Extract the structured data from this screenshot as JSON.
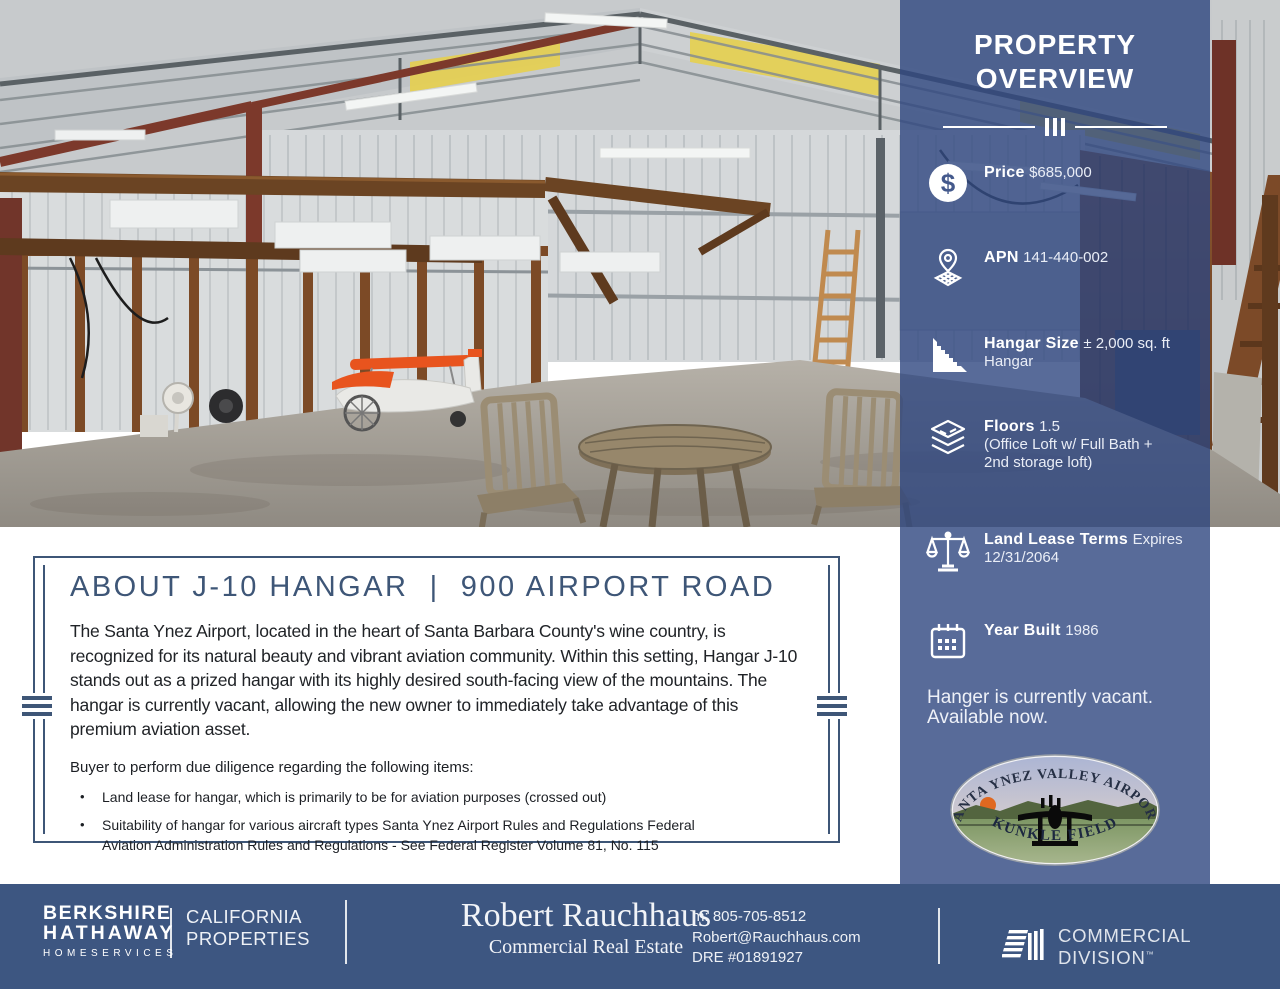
{
  "sidebar": {
    "title": "PROPERTY OVERVIEW",
    "facts": [
      {
        "icon": "dollar-icon",
        "label": "Price",
        "value": "$685,000"
      },
      {
        "icon": "map-pin-icon",
        "label": "APN",
        "value": "141-440-002"
      },
      {
        "icon": "ruler-icon",
        "label": "Hangar Size",
        "value": "± 2,000 sq. ft Hangar"
      },
      {
        "icon": "layers-icon",
        "label": "Floors",
        "value": "1.5\n(Office Loft w/ Full Bath +\n2nd storage loft)"
      },
      {
        "icon": "scale-icon",
        "label": "Land Lease Terms",
        "value": "Expires 12/31/2064"
      },
      {
        "icon": "calendar-icon",
        "label": "Year Built",
        "value": "1986"
      }
    ],
    "note": "Hanger is currently vacant.\nAvailable now.",
    "logo": {
      "top_text": "SANTA YNEZ VALLEY AIRPORT",
      "bottom_text": "KUNKLE FIELD"
    }
  },
  "about": {
    "title": "ABOUT J-10 HANGAR  |  900 AIRPORT ROAD",
    "paragraph": "The Santa Ynez Airport, located in the heart of Santa Barbara County's wine country, is recognized for its natural beauty and vibrant aviation community. Within this setting, Hangar J-10 stands out as a prized hangar with its highly desired south-facing view of the mountains. The hangar is currently vacant, allowing the new owner to immediately take advantage of this premium aviation asset.",
    "list_intro": "Buyer to perform due diligence regarding the following items:",
    "bullets": [
      "Land lease for hangar, which is primarily to be for aviation purposes (crossed out)",
      "Suitability of hangar for various aircraft types Santa Ynez Airport Rules and Regulations Federal Aviation Administration Rules and Regulations - See Federal Register Volume 81, No. 115"
    ]
  },
  "footer": {
    "brand": {
      "line1": "BERKSHIRE",
      "line2": "HATHAWAY",
      "line3": "HOMESERVICES"
    },
    "division": {
      "line1": "CALIFORNIA",
      "line2": "PROPERTIES"
    },
    "agent": {
      "name": "Robert Rauchhaus",
      "tagline": "Commercial Real Estate"
    },
    "contact": {
      "phone": "m: 805-705-8512",
      "email": "Robert@Rauchhaus.com",
      "dre": "DRE #01891927"
    },
    "commercial_division": "COMMERCIAL DIVISION",
    "trademark": "™"
  },
  "colors": {
    "accent": "#3e5677",
    "sidebar_overlay": "#2e4680",
    "footer": "#3d5681"
  }
}
